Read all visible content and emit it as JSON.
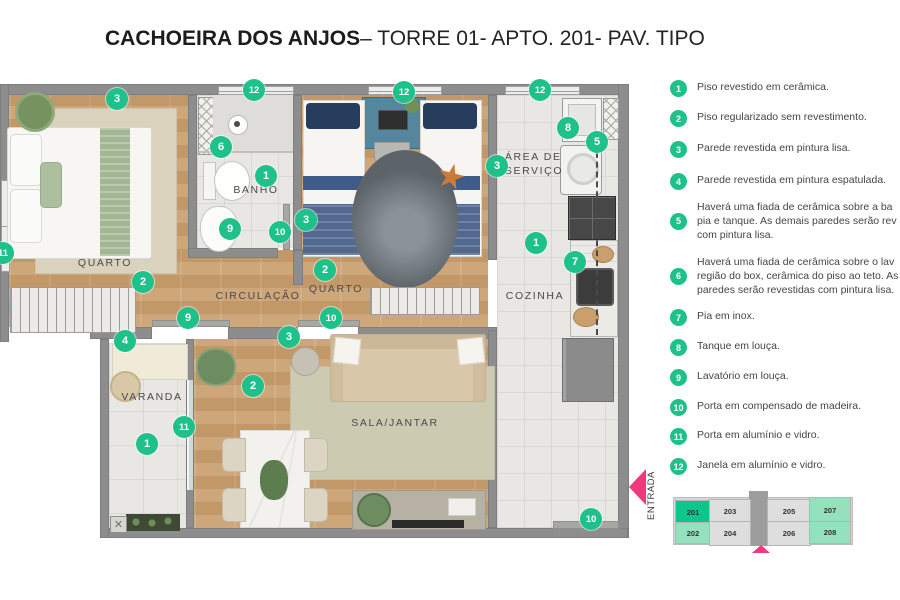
{
  "title": {
    "bold": "CACHOEIRA DOS ANJOS",
    "regular": "– TORRE 01- APTO. 201- PAV. TIPO"
  },
  "colors": {
    "accent_green": "#1ec189",
    "keyplan_selected": "#0cc78c",
    "keyplan_mint": "#93e1bd",
    "keyplan_gray": "#dedede",
    "keyplan_core": "#9d9d9d",
    "entrada_pink": "#f0387e"
  },
  "plan": {
    "rooms": [
      {
        "id": "quarto-1",
        "label": "QUARTO",
        "x": 105,
        "y": 263
      },
      {
        "id": "banho",
        "label": "BANHO",
        "x": 256,
        "y": 190
      },
      {
        "id": "circulacao",
        "label": "CIRCULAÇÃO",
        "x": 258,
        "y": 296
      },
      {
        "id": "quarto-2",
        "label": "QUARTO",
        "x": 336,
        "y": 289
      },
      {
        "id": "area-de-servico",
        "label": "ÁREA DE\nSERVIÇO",
        "x": 534,
        "y": 164
      },
      {
        "id": "cozinha",
        "label": "COZINHA",
        "x": 535,
        "y": 296
      },
      {
        "id": "varanda",
        "label": "VARANDA",
        "x": 152,
        "y": 397
      },
      {
        "id": "sala-jantar",
        "label": "SALA/JANTAR",
        "x": 395,
        "y": 423
      }
    ],
    "markers": [
      {
        "n": "3",
        "x": 117,
        "y": 99
      },
      {
        "n": "12",
        "x": 254,
        "y": 90
      },
      {
        "n": "12",
        "x": 404,
        "y": 92
      },
      {
        "n": "12",
        "x": 540,
        "y": 90
      },
      {
        "n": "8",
        "x": 568,
        "y": 128
      },
      {
        "n": "5",
        "x": 597,
        "y": 142
      },
      {
        "n": "6",
        "x": 221,
        "y": 147
      },
      {
        "n": "1",
        "x": 266,
        "y": 176
      },
      {
        "n": "3",
        "x": 497,
        "y": 166
      },
      {
        "n": "3",
        "x": 306,
        "y": 220
      },
      {
        "n": "9",
        "x": 230,
        "y": 229
      },
      {
        "n": "10",
        "x": 280,
        "y": 232
      },
      {
        "n": "11",
        "x": 3,
        "y": 253
      },
      {
        "n": "2",
        "x": 143,
        "y": 282
      },
      {
        "n": "2",
        "x": 325,
        "y": 270
      },
      {
        "n": "1",
        "x": 536,
        "y": 243
      },
      {
        "n": "7",
        "x": 575,
        "y": 262
      },
      {
        "n": "4",
        "x": 125,
        "y": 341
      },
      {
        "n": "9",
        "x": 188,
        "y": 318
      },
      {
        "n": "3",
        "x": 289,
        "y": 337
      },
      {
        "n": "10",
        "x": 331,
        "y": 318
      },
      {
        "n": "2",
        "x": 253,
        "y": 386
      },
      {
        "n": "11",
        "x": 184,
        "y": 427
      },
      {
        "n": "1",
        "x": 147,
        "y": 444
      },
      {
        "n": "10",
        "x": 591,
        "y": 519
      }
    ]
  },
  "legend": [
    {
      "n": "1",
      "top": 80,
      "lines": [
        "Piso revestido em cerâmica."
      ]
    },
    {
      "n": "2",
      "top": 110,
      "lines": [
        "Piso regularizado sem revestimento."
      ]
    },
    {
      "n": "3",
      "top": 141,
      "lines": [
        "Parede revestida em pintura lisa."
      ]
    },
    {
      "n": "4",
      "top": 173,
      "lines": [
        "Parede revestida em pintura espatulada."
      ]
    },
    {
      "n": "5",
      "top": 200,
      "lines": [
        "Haverá uma fiada de cerâmica sobre a ba",
        "pia e tanque. As demais paredes serão rev",
        "com pintura lisa."
      ]
    },
    {
      "n": "6",
      "top": 255,
      "lines": [
        "Haverá uma fiada de cerâmica sobre o lav",
        "região do box, cerâmica do piso ao teto. As",
        "paredes serão revestidas com pintura lisa."
      ]
    },
    {
      "n": "7",
      "top": 309,
      "lines": [
        "Pia em inox."
      ]
    },
    {
      "n": "8",
      "top": 339,
      "lines": [
        "Tanque em louça."
      ]
    },
    {
      "n": "9",
      "top": 369,
      "lines": [
        "Lavatório em louça."
      ]
    },
    {
      "n": "10",
      "top": 399,
      "lines": [
        "Porta em compensado de madeira."
      ]
    },
    {
      "n": "11",
      "top": 428,
      "lines": [
        "Porta em alumínio e vidro."
      ]
    },
    {
      "n": "12",
      "top": 458,
      "lines": [
        "Janela em alumínio e vidro."
      ]
    }
  ],
  "entrada": {
    "label": "ENTRADA"
  },
  "keyplan": {
    "units": [
      {
        "num": "201",
        "state": "selected"
      },
      {
        "num": "203",
        "state": "default"
      },
      {
        "num": "205",
        "state": "default"
      },
      {
        "num": "207",
        "state": "mint"
      },
      {
        "num": "202",
        "state": "mint"
      },
      {
        "num": "204",
        "state": "default"
      },
      {
        "num": "206",
        "state": "default"
      },
      {
        "num": "208",
        "state": "mint"
      }
    ]
  }
}
